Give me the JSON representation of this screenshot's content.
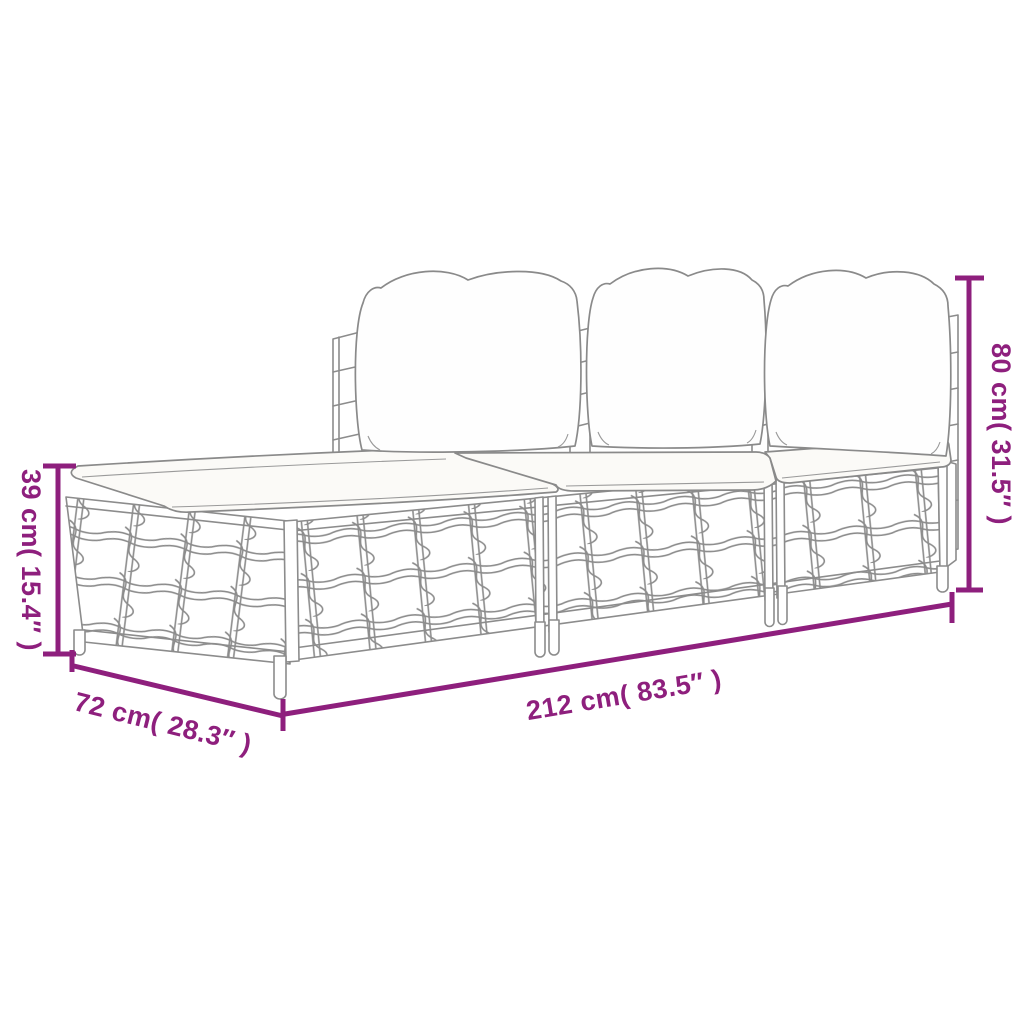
{
  "diagram": {
    "kind": "product-dimension-diagram",
    "subject": "3-piece poly rattan garden lounge set with back pillows and seat cushions",
    "background": "#ffffff",
    "colors": {
      "dimension_accent": "#8e1f7d",
      "line_art_gray": "#8c8c8c",
      "background": "#ffffff"
    },
    "dimensions": {
      "height": {
        "label": "80 cm( 31.5″ )",
        "value_cm": 80,
        "value_in": 31.5,
        "placement": "right-vertical"
      },
      "seat_height": {
        "label": "39 cm( 15.4″ )",
        "value_cm": 39,
        "value_in": 15.4,
        "placement": "left-vertical"
      },
      "depth": {
        "label": "72 cm( 28.3″ )",
        "value_cm": 72,
        "value_in": 28.3,
        "placement": "bottom-left-diagonal"
      },
      "width": {
        "label": "212 cm( 83.5″ )",
        "value_cm": 212,
        "value_in": 83.5,
        "placement": "bottom-center-diagonal"
      }
    }
  }
}
